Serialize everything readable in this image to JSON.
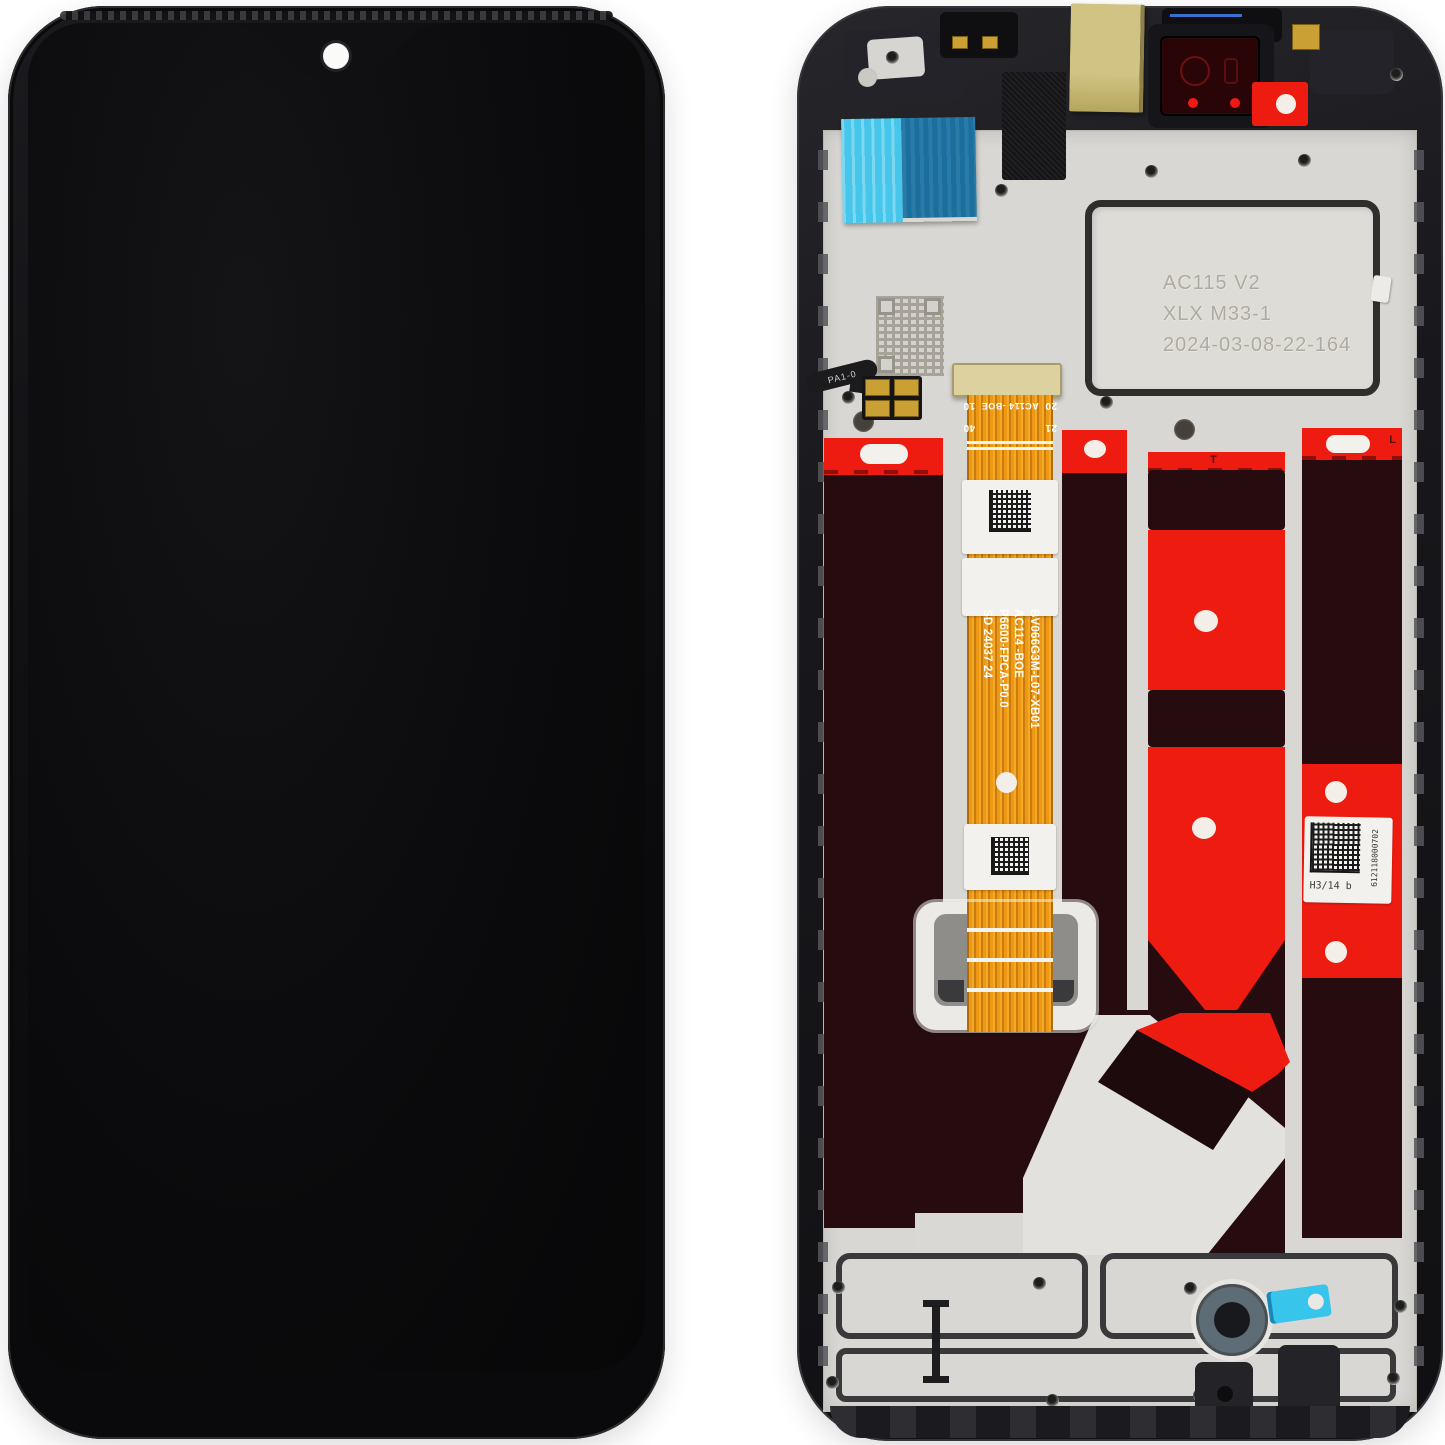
{
  "back_assembly": {
    "etched_plate": {
      "line1": "AC115 V2",
      "line2": "XLX M33-1",
      "line3": "2024-03-08-22-164"
    },
    "main_flex": {
      "lines": [
        "BV066G3M-L07-XB01",
        "AC114 -BOE",
        "P6600-FPCA-P0.0",
        "SD 24037 24"
      ],
      "top_marks": {
        "row1_left": "20",
        "row1_center": "AC114 -BOE",
        "row1_right": "10",
        "row2_left": "21",
        "row2_right": "40"
      }
    },
    "serial_label": {
      "code": "H3/14 b",
      "serial": "612118000702"
    },
    "small_flex_label": "PA1-0",
    "strip_marks": {
      "strip3_top": "T",
      "strip4_top": "L"
    },
    "colors": {
      "adhesive_red": "#ee1b10",
      "lcd_back_maroon": "#270c0f",
      "flex_orange": "#ee9813",
      "tape_cyan": "#45c6ea",
      "tape_blue": "#1a6f9f",
      "tape_yellow": "#d0c383",
      "backplate_gray": "#d9d7d3",
      "frame_black": "#1a1a1e",
      "camera_ring_gray": "#5e6d75",
      "pull_tab_cyan": "#38c5ec"
    }
  },
  "front_phone": {
    "camera_dot_color": "#fafafa",
    "body_color": "#101013",
    "screen_color": "#0b0b0d"
  }
}
